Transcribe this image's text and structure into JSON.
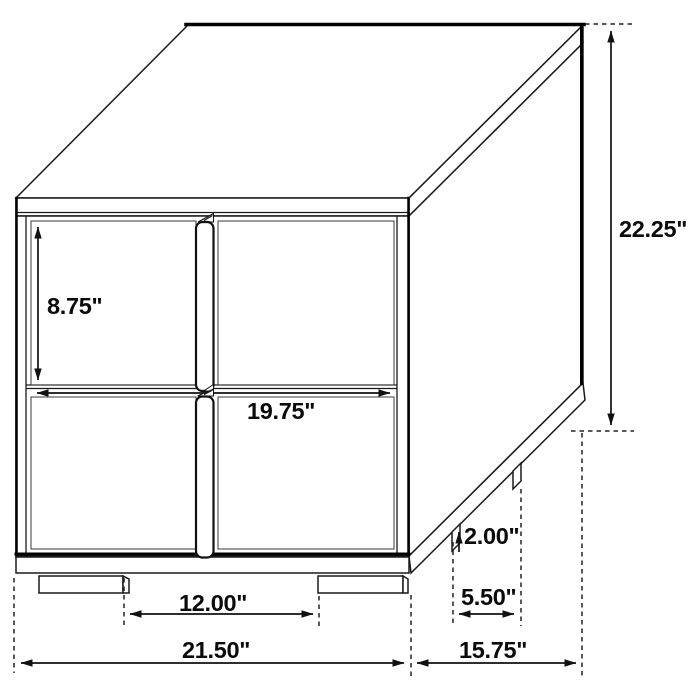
{
  "drawing": {
    "subject": "two-drawer nightstand dimension diagram",
    "units": "inches",
    "labels": {
      "drawer_front_height": "8.75\"",
      "overall_height": "22.25\"",
      "drawer_width": "19.75\"",
      "leg_height": "2.00\"",
      "side_leg_spacing": "5.50\"",
      "front_leg_spacing": "12.00\"",
      "overall_width": "21.50\"",
      "overall_depth": "15.75\""
    }
  }
}
